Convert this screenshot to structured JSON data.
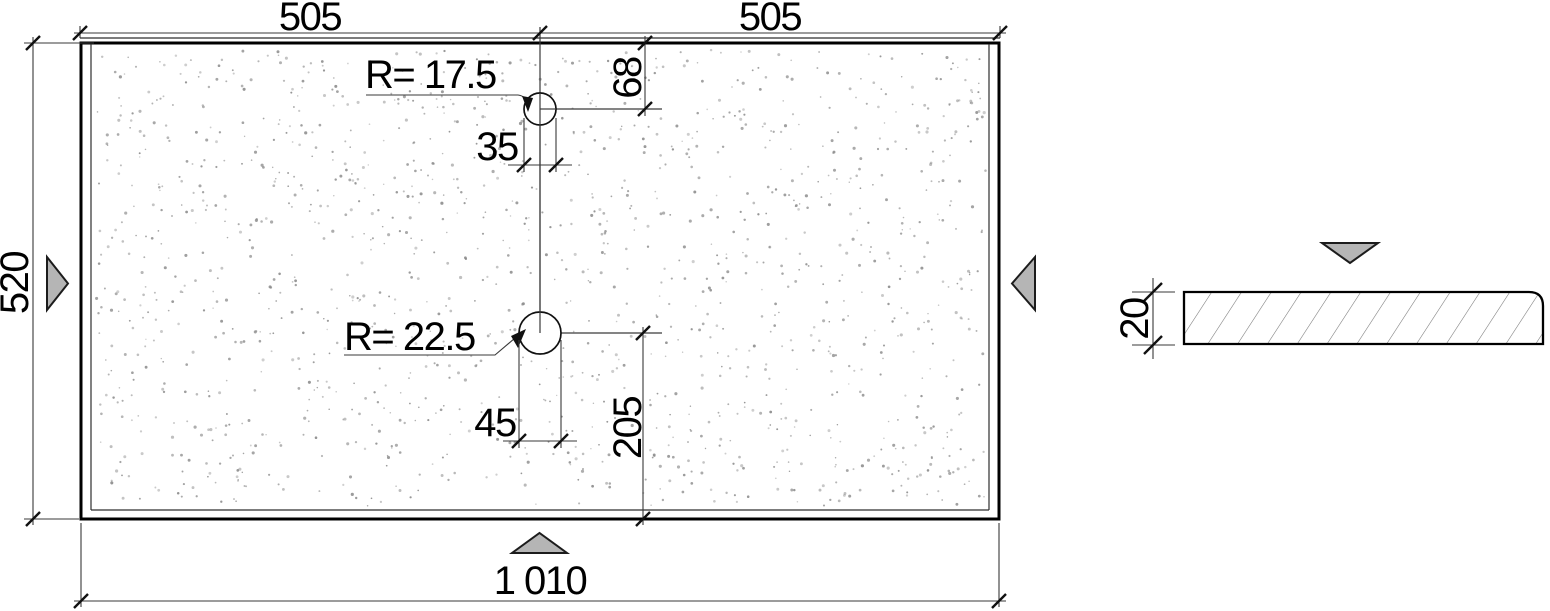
{
  "title": "panel-dimension-drawing",
  "labels": {
    "top_left_width": "505",
    "top_right_width": "505",
    "total_width": "1 010",
    "height": "520",
    "hole1_radius": "R= 17.5",
    "hole1_offset_top": "68",
    "hole1_diameter": "35",
    "hole2_radius": "R= 22.5",
    "hole2_diameter": "45",
    "hole2_offset_bottom": "205",
    "section_thickness": "20"
  },
  "colors": {
    "line": "#000000",
    "dimension": "#3a3a3a",
    "triangle_fill": "#b5b5b5",
    "stipple": "#8a8a8a",
    "hatch": "#777777"
  },
  "stipple": {
    "count": 1500,
    "seed": 42
  }
}
